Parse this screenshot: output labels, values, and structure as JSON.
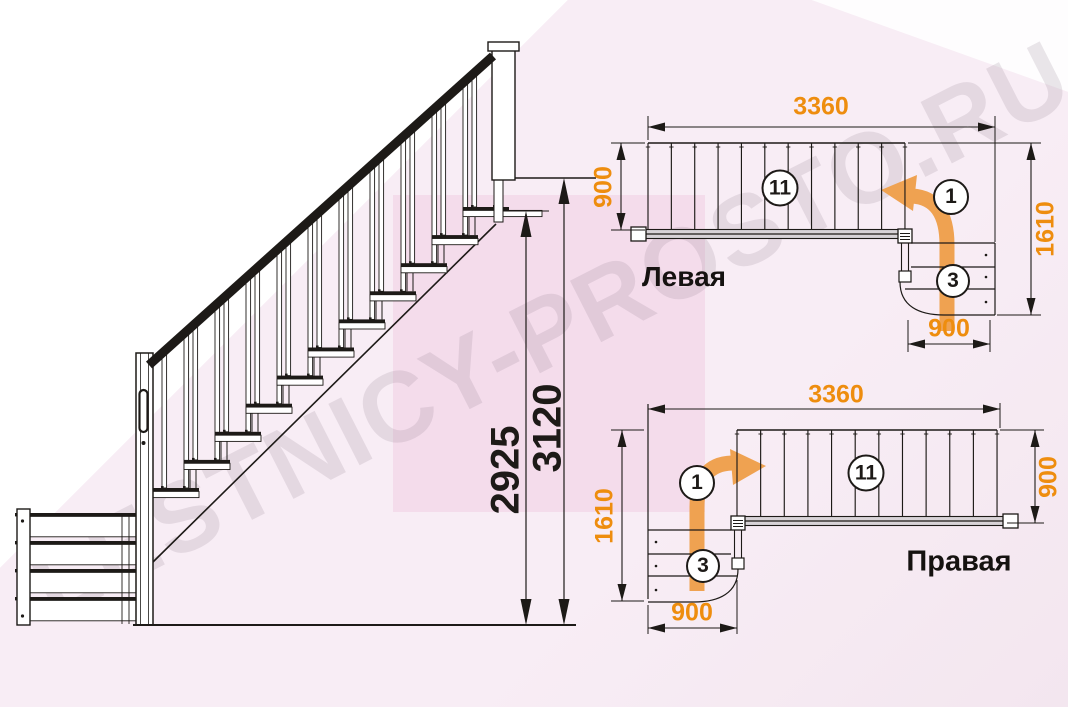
{
  "watermark": "LESTNICY-PROSTO.RU",
  "colors": {
    "dimension_text_orange": "#ee8d0e",
    "direction_arrow_orange": "#efa251",
    "ink": "#1d1a17",
    "background_pink": "#f8edf5"
  },
  "elevation": {
    "dim_height_to_top_step": "2925",
    "dim_height_to_floor": "3120"
  },
  "plan_left": {
    "label": "Левая",
    "dim_length": "3360",
    "dim_flight_width": "900",
    "dim_total_depth": "1610",
    "dim_turn_width": "900",
    "straight_steps_count": "11",
    "first_step_number": "1",
    "turn_steps_count": "3"
  },
  "plan_right": {
    "label": "Правая",
    "dim_length": "3360",
    "dim_flight_width": "900",
    "dim_total_depth": "1610",
    "dim_turn_width": "900",
    "straight_steps_count": "11",
    "first_step_number": "1",
    "turn_steps_count": "3"
  }
}
